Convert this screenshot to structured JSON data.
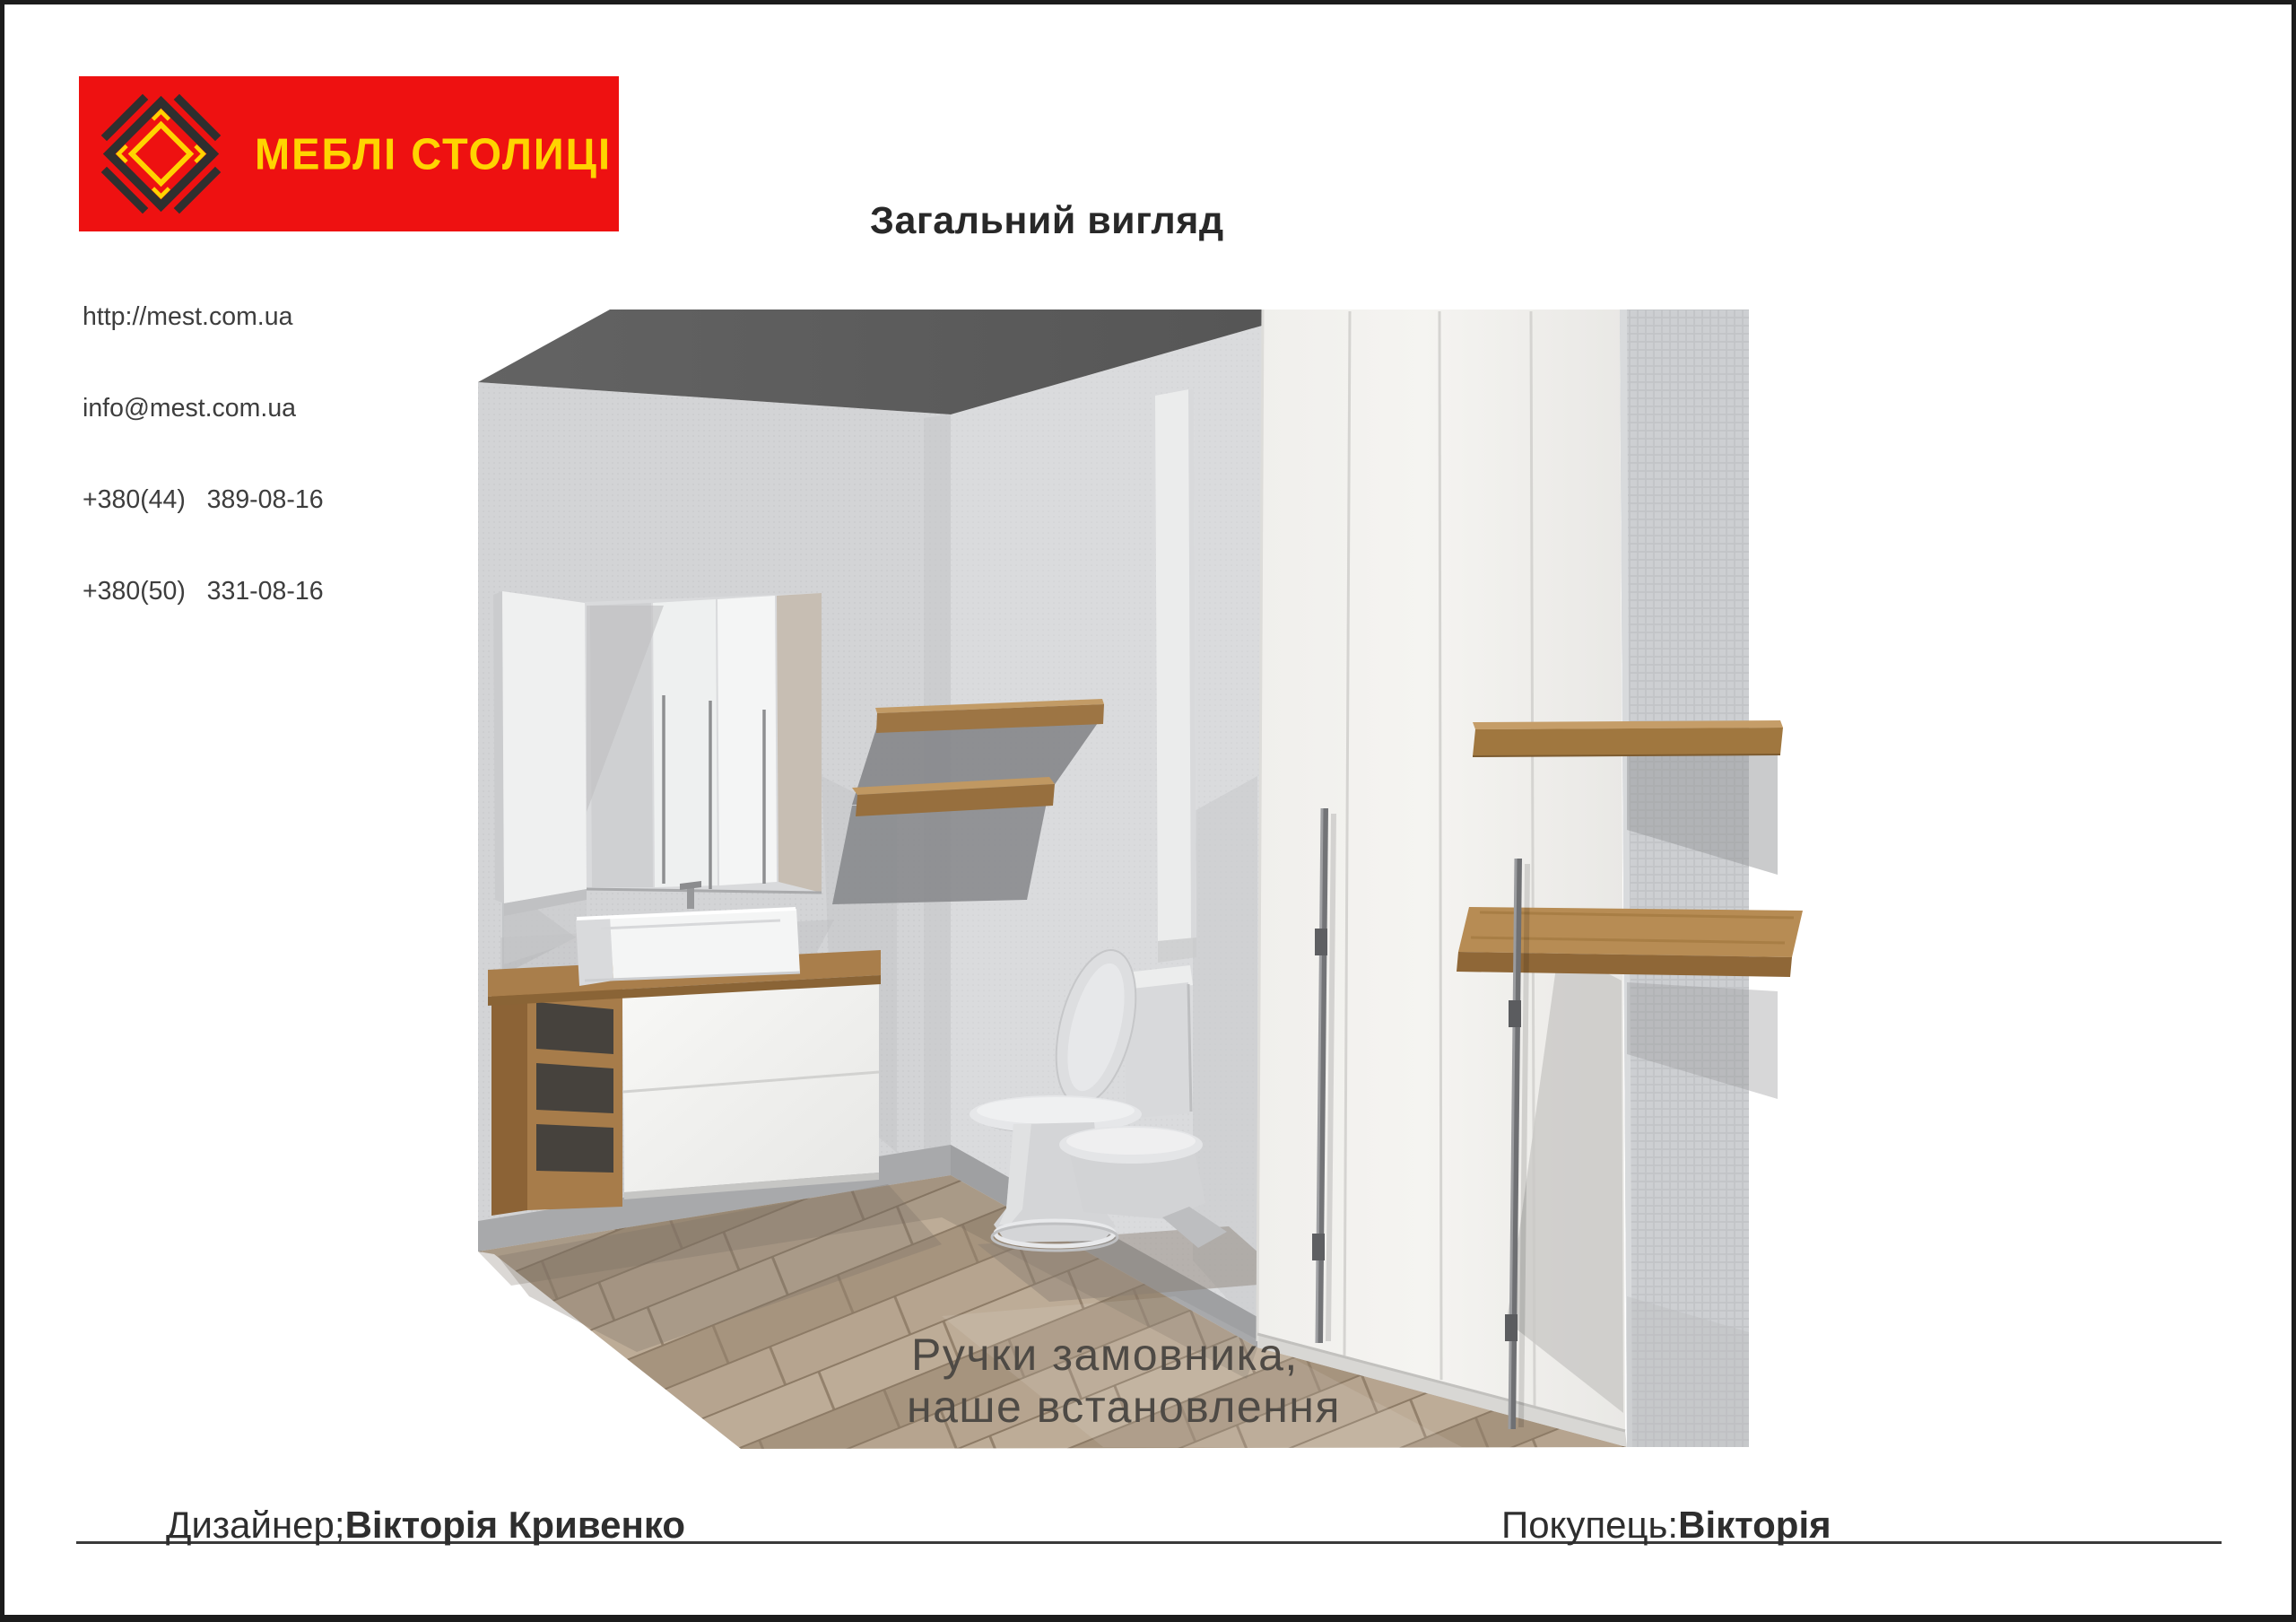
{
  "header": {
    "logo": {
      "text": "МЕБЛІ СТОЛИЦІ"
    },
    "contact": [
      "http://mest.com.ua",
      "info@mest.com.ua",
      "+380(44)   389-08-16",
      "+380(50)   331-08-16"
    ],
    "title": "Загальний вигляд"
  },
  "render": {
    "annotation": [
      "Ручки замовника,",
      "наше встановлення"
    ]
  },
  "footer": {
    "designer_label": "Дизайнер;",
    "designer_name": "Вікторія Кривенко",
    "customer_label": "Покупець:",
    "customer_name": "Вікторія"
  },
  "colors": {
    "brand_red": "#ee1111",
    "brand_yellow": "#ffd400",
    "logo_dark": "#2f2f2f",
    "wood": "#a97e4b",
    "wall_gray": "#d3d4d6",
    "ceiling_gray": "#5d5d5d"
  }
}
